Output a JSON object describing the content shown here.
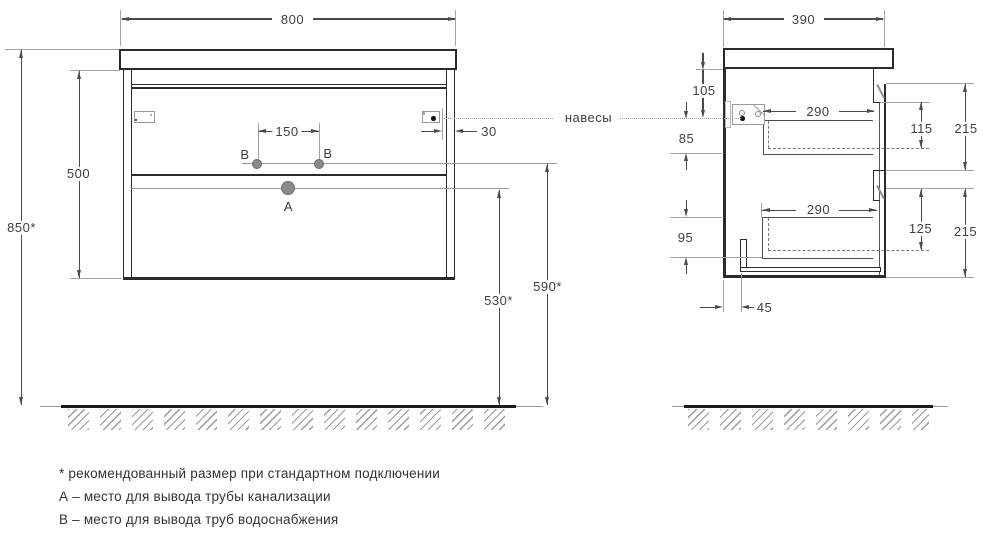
{
  "front_view": {
    "width_mm": "800",
    "cabinet_height_mm": "500",
    "install_height_mm": "850*",
    "drain_outlet_height_mm": "530*",
    "water_outlet_height_mm": "590*",
    "water_outlet_spacing_mm": "150",
    "hanger_edge_offset_mm": "30",
    "point_a_label": "A",
    "point_b_label": "B"
  },
  "side_view": {
    "depth_mm": "390",
    "hanger_top_offset_mm": "105",
    "hanger_drop_mm": "85",
    "lower_drawer_back_mm": "95",
    "upper_drawer_depth_mm": "290",
    "lower_drawer_depth_mm": "290",
    "upper_drawer_inner_mm": "115",
    "lower_drawer_inner_mm": "125",
    "upper_front_height_mm": "215",
    "lower_front_height_mm": "215",
    "bottom_back_offset_mm": "45"
  },
  "labels": {
    "hangers": "навесы"
  },
  "notes": {
    "asterisk": "* рекомендованный размер при стандартном подключении",
    "a": "А – место для вывода трубы канализации",
    "b": "В – место для вывода труб водоснабжения"
  }
}
